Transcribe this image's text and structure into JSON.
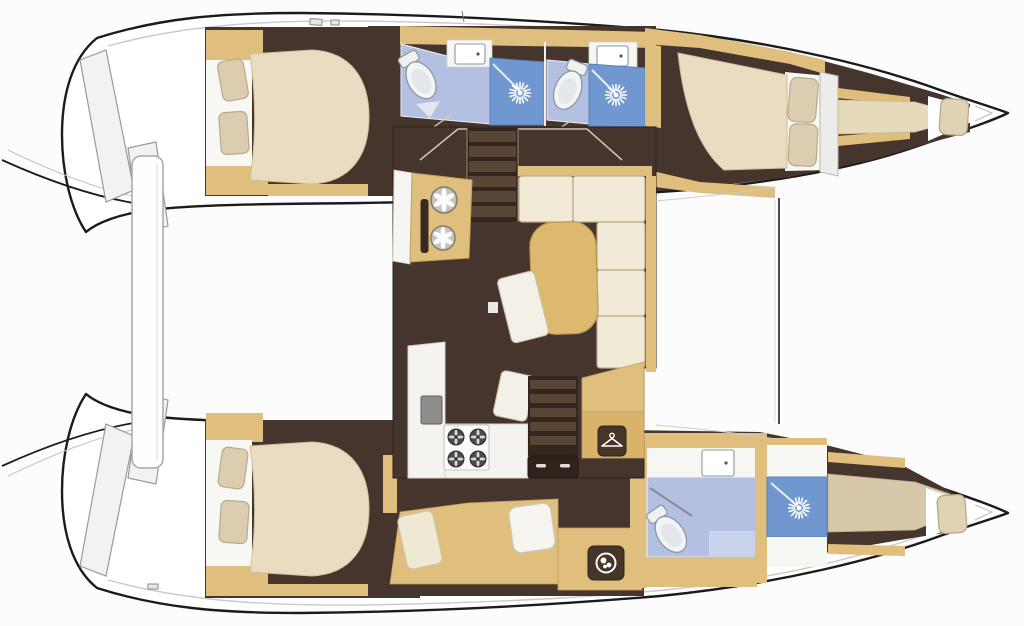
{
  "figure": {
    "kind": "catamaran-floor-plan",
    "view": "top-down",
    "bow_direction": "right",
    "hull_count": 2
  },
  "palette": {
    "bg": "#fcfcfc",
    "outline": "#1b1b1b",
    "deck": "#ffffff",
    "deck_line": "#c9c9c9",
    "floor": "#46352c",
    "floor_dark": "#33261e",
    "tread": "#584536",
    "wood": "#dfbe7e",
    "wood_dark": "#d9b36a",
    "wood_edge": "#c49f5e",
    "mattress": "#e9dcc0",
    "mattress_edge": "#cdbf9f",
    "cushion": "#f0ead6",
    "cushion_edge": "#b8ab8d",
    "pillow": "#ddcdb0",
    "pillow_edge": "#b9a98c",
    "bath": "#b3c0e2",
    "bath_light": "#c9d3ec",
    "shower": "#7097cf",
    "shower_edge": "#5b82bb",
    "fixture": "#f0f2f4",
    "fixture_edge": "#8e979e",
    "white": "#f6f6f3",
    "counter_edge": "#d5d2ca",
    "gray_sink": "#8d8d8b",
    "table": "#dcb96e",
    "table_edge": "#c09a52",
    "icon_bg": "#463528",
    "step_fill": "#f2f2f2",
    "step_edge": "#9a9a9a",
    "metal": "#a8a8a8"
  },
  "regions": {
    "hull_top": [
      "aft-double-cabin",
      "aft-head-with-shower",
      "forward-head-with-shower",
      "forward-double-cabin",
      "forepeak-berth"
    ],
    "hull_bottom": [
      "aft-double-cabin",
      "settee-berth",
      "washing-machine-cabinet",
      "head-with-shower",
      "forward-berth"
    ],
    "bridgedeck_salon": [
      "companionway-stairs",
      "forward-galley-counter-round-sinks",
      "l-shaped-settee",
      "salon-table",
      "chairs",
      "galley-counter-sink-stove",
      "aft-companionway-stairs",
      "wardrobe-cabinet"
    ]
  },
  "icons": [
    {
      "name": "shower-sunburst-icon",
      "count": 3
    },
    {
      "name": "toilet-icon",
      "count": 3
    },
    {
      "name": "sink-icon",
      "count": 3
    },
    {
      "name": "round-sink-icon",
      "count": 2
    },
    {
      "name": "stove-burner-icon",
      "count": 4
    },
    {
      "name": "hanger-icon",
      "count": 1
    },
    {
      "name": "washing-machine-icon",
      "count": 1
    }
  ]
}
